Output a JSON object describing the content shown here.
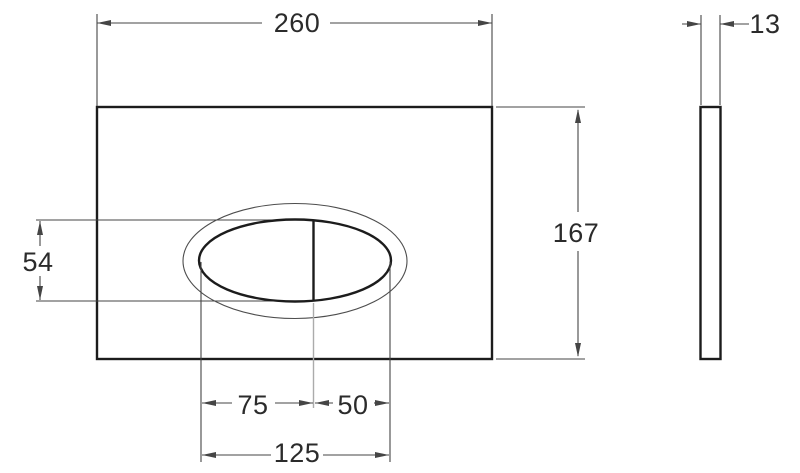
{
  "dimensions": {
    "plate_width": "260",
    "plate_thickness": "13",
    "plate_height": "167",
    "button_height": "54",
    "button_large_width": "75",
    "button_small_width": "50",
    "button_total_width": "125"
  },
  "colors": {
    "background": "#ffffff",
    "outline": "#1c1c1c",
    "dimension": "#454545",
    "light_line": "#ababab",
    "text": "#2b2b2b"
  }
}
